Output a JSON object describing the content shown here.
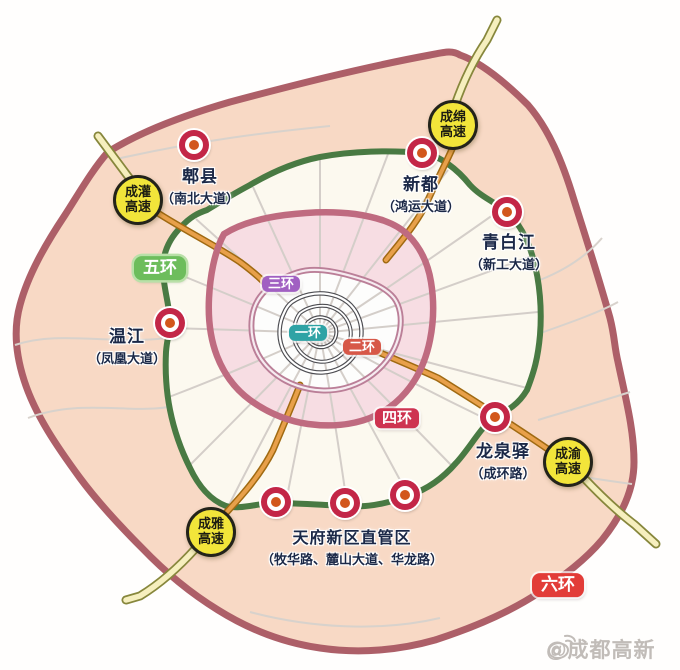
{
  "rings": {
    "ring1": {
      "label": "一环",
      "color": "#2fa3a5"
    },
    "ring2": {
      "label": "二环",
      "color": "#d75848"
    },
    "ring3": {
      "label": "三环",
      "color": "#a160c2"
    },
    "ring4": {
      "label": "四环",
      "color": "#ce3350"
    },
    "ring5": {
      "label": "五环",
      "color": "#6dbd5c"
    },
    "ring6": {
      "label": "六环",
      "color": "#e23c38"
    }
  },
  "highways": {
    "chengguan": {
      "line1": "成灌",
      "line2": "高速"
    },
    "chengmian": {
      "line1": "成绵",
      "line2": "高速"
    },
    "chengyu": {
      "line1": "成渝",
      "line2": "高速"
    },
    "chengya": {
      "line1": "成雅",
      "line2": "高速"
    }
  },
  "districts": {
    "pixian": {
      "name": "郫县",
      "road": "（南北大道）"
    },
    "xindu": {
      "name": "新都",
      "road": "（鸿运大道）"
    },
    "qingbaijiang": {
      "name": "青白江",
      "road": "（新工大道）"
    },
    "wenjiang": {
      "name": "温江",
      "road": "（凤凰大道）"
    },
    "longquanyi": {
      "name": "龙泉驿",
      "road": "（成环路）"
    },
    "tianfu": {
      "name": "天府新区直管区",
      "road": "（牧华路、麓山大道、华龙路）"
    }
  },
  "watermark": {
    "handle": "@成都高新"
  }
}
